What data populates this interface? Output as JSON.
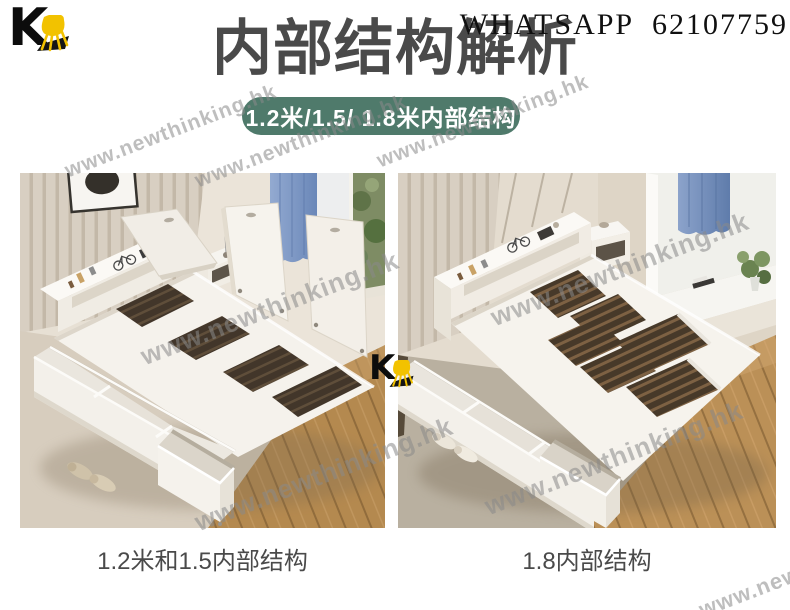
{
  "brand": {
    "letter": "K"
  },
  "header": {
    "whatsapp": "WHATSAPP  62107759",
    "title": "内部结构解析",
    "badge": "1.2米/1.5/ 1.8米内部结构"
  },
  "watermark": {
    "text": "www.newthinking.hk"
  },
  "photos": {
    "left": {
      "caption": "1.2米和1.5内部结构"
    },
    "right": {
      "caption": "1.8内部结构"
    }
  },
  "colors": {
    "badge_bg": "#4f7a6b",
    "title_text": "#4a4a4a",
    "caption_text": "#4a4a4a",
    "whatsapp_text": "#101010",
    "chair_yellow": "#f2c200",
    "logo_black": "#0c0c0c",
    "curtain_blue": "#7e98c5",
    "wall_beige": "#e4dccf",
    "wood_floor": "#b4894f",
    "watermark_gray": "#8a8a8a"
  }
}
